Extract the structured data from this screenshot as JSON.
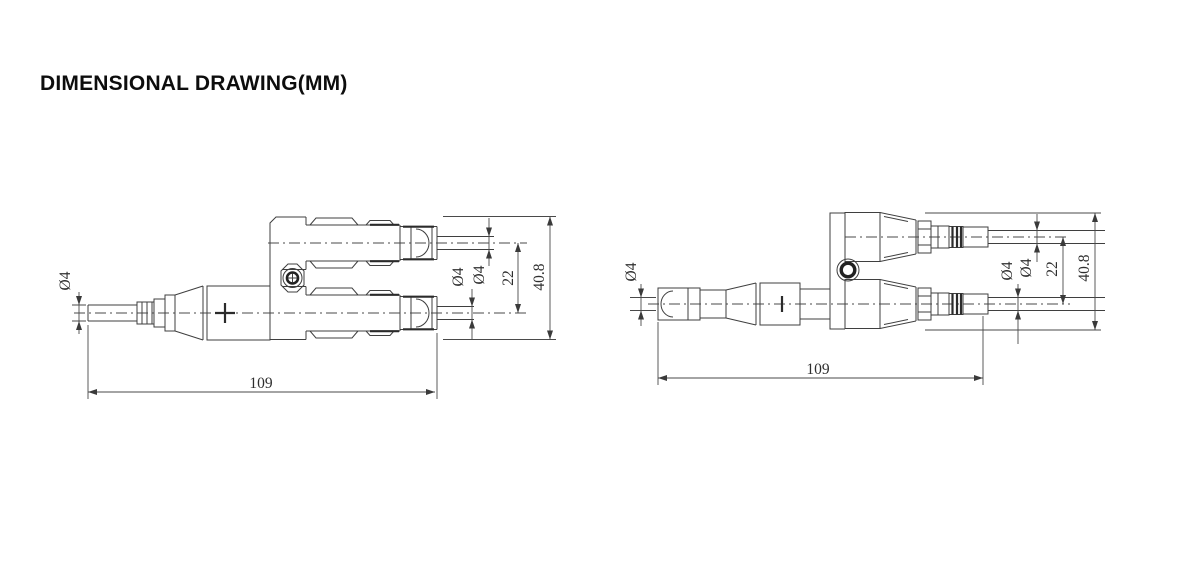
{
  "title": "DIMENSIONAL DRAWING(MM)",
  "units": "mm",
  "colors": {
    "background": "#ffffff",
    "line": "#3f3f3f",
    "dimension_line": "#4a4a4a",
    "text": "#2e2e2e",
    "title_text": "#0d0d0d"
  },
  "drawings": {
    "left": {
      "description": "Y-branch solar connector, side view, single male end left and two female ends right",
      "polarity_marking": "+",
      "dimensions": {
        "cable_diameter_left": "Ø4",
        "cable_diameter_lower": "Ø4",
        "cable_diameter_upper": "Ø4",
        "branch_spacing": "22",
        "overall_height": "40.8",
        "overall_length": "109"
      }
    },
    "right": {
      "description": "Y-branch solar connector, side view, single female end left and two male ends right",
      "polarity_marking": "−",
      "dimensions": {
        "cable_diameter_left": "Ø4",
        "cable_diameter_lower": "Ø4",
        "cable_diameter_upper": "Ø4",
        "branch_spacing": "22",
        "overall_height": "40.8",
        "overall_length": "109"
      }
    }
  }
}
